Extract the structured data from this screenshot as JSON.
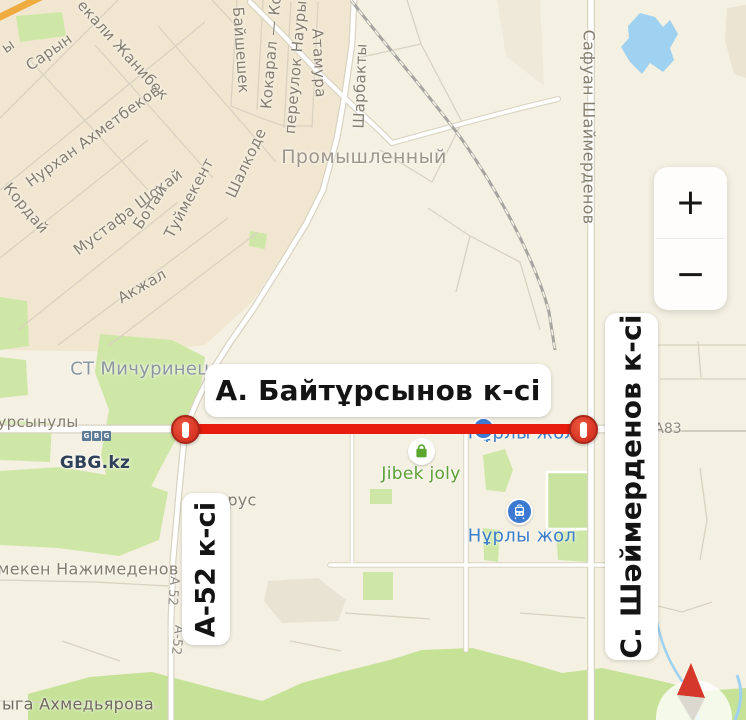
{
  "closure": {
    "main_label": "А. Байтұрсынов к-сі",
    "left_cross_label": "А-52 к-сі",
    "right_cross_label": "С. Шәймерденов к-сі"
  },
  "controls": {
    "zoom_in": "+",
    "zoom_out": "−"
  },
  "streets": {
    "partial_y": "ы",
    "saryn": "Сарын",
    "zhanibek": "екали Жанибек",
    "nurkhan_akhmetbekov": "Нурхан Ахметбеков",
    "korday": "Кордай",
    "mustafa_shokay": "Мустафа Шокай",
    "botay": "Ботай",
    "tuymekent": "Туймекент",
    "shalkode": "Шалкоде",
    "akzhal": "Акжал",
    "baysheshek": "Байшешек",
    "kokaral": "Кокарал — Ко",
    "pereulok_nauryz": "переулок Наурыз",
    "atamura": "Атамура",
    "sharbakty": "Шарбакты",
    "safuan_shaymerdenov": "Сафуан Шаймерденов",
    "ursynuly": "урсынулы",
    "nazhimedenov": "мекен Нажимеденов",
    "akhmedyarova": "ыга Ахмедьярова",
    "partial_rus": "рус",
    "a52_marker_1": "А 52",
    "a52_marker_2": "А-52",
    "a83_marker": "А83"
  },
  "places": {
    "promyshlenny": "Промышленный",
    "st_michurinets": "СТ Мичуринец"
  },
  "pois": {
    "gbg": {
      "name": "GBG.kz",
      "logo_chars": [
        "G",
        "B",
        "G"
      ]
    },
    "jibek_joly": {
      "name": "Jibek joly"
    },
    "nurly_zhol_top": {
      "name": "Нұрлы жол"
    },
    "nurly_zhol_station": {
      "name": "Нұрлы жол"
    }
  },
  "colors": {
    "closure_red": "#e81c0d",
    "water_blue": "#9ed2f0",
    "park_green": "#cfe7a6",
    "poi_green": "#5b9f35",
    "transit_blue": "#3c7dc7",
    "residential_tan": "#f1e7d1"
  }
}
